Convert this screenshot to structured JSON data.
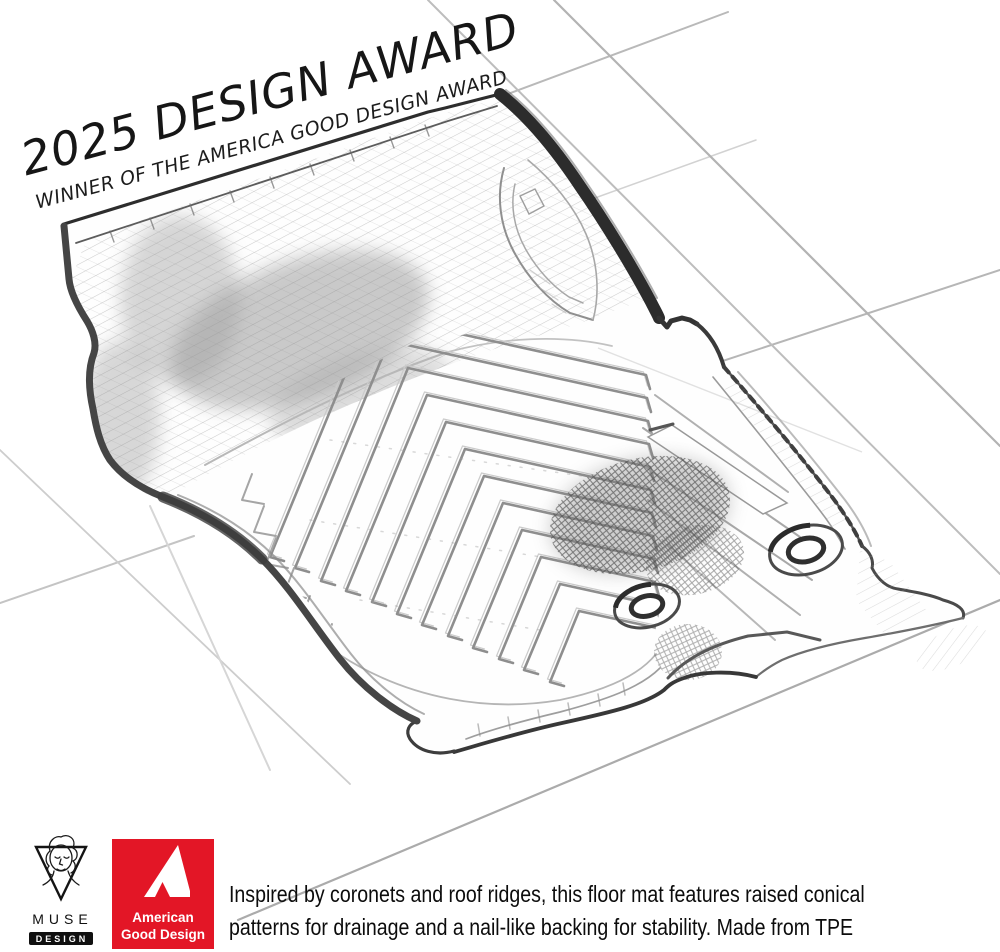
{
  "banner": {
    "title": "2025 DESIGN AWARD",
    "subtitle": "WINNER OF THE AMERICA GOOD DESIGN AWARD"
  },
  "caption": {
    "line1": "Inspired by coronets and roof ridges, this floor mat features raised conical",
    "line2": "patterns for drainage and a nail-like backing for stability. Made from TPE"
  },
  "logos": {
    "muse": {
      "brand": "MUSE",
      "tier": "DESIGN",
      "suffix": "AWARDS"
    },
    "agd": {
      "line1": "American",
      "line2": "Good Design",
      "red": "#e31626",
      "bg_style": "background:#e31626"
    }
  },
  "sketch": {
    "subject": "Pencil sketch of a car floor mat with raised chevron ridge pattern, two grommets and perspective grid",
    "ink": "#3c3c3c",
    "grid_color": "#bdbdbd"
  }
}
